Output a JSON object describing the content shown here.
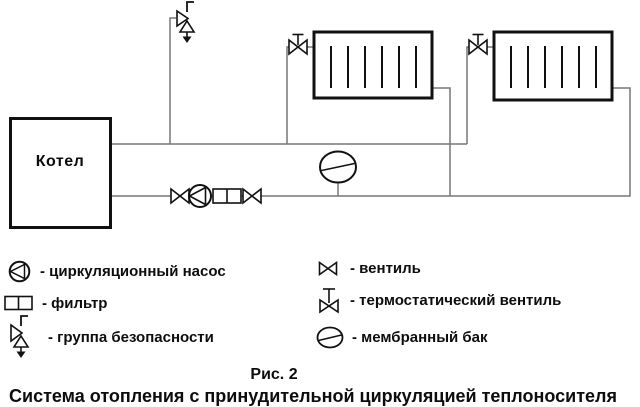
{
  "diagram": {
    "boiler_label": "Котел"
  },
  "legend": {
    "left": [
      {
        "symbol": "pump-icon",
        "label": "- циркуляционный насос"
      },
      {
        "symbol": "filter-icon",
        "label": "- фильтр"
      },
      {
        "symbol": "safety-group-icon",
        "label": "- группа безопасности"
      }
    ],
    "right": [
      {
        "symbol": "valve-icon",
        "label": "- вентиль"
      },
      {
        "symbol": "thermostatic-valve-icon",
        "label": "- термостатический вентиль"
      },
      {
        "symbol": "membrane-tank-icon",
        "label": "- мембранный бак"
      }
    ]
  },
  "caption": {
    "figure_number": "Рис. 2",
    "title": "Система отопления с принудительной циркуляцией теплоносителя"
  },
  "colors": {
    "pipe": "#777777",
    "symbol": "#111111",
    "background": "#ffffff"
  }
}
